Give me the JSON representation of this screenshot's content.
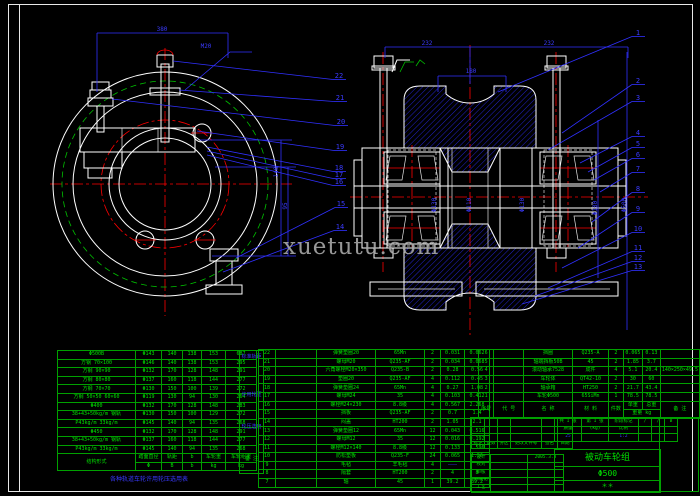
{
  "watermark": {
    "text": "xuetutu.com"
  },
  "colors": {
    "line_white": "#ffffff",
    "line_green": "#00c000",
    "line_red": "#ff0000",
    "line_blue": "#3030ff",
    "table_green": "#00e000",
    "background": "#000000"
  },
  "drawing": {
    "callouts": [
      {
        "n": "22",
        "x": 339,
        "y": 78,
        "fx": 173,
        "fy": 61
      },
      {
        "n": "21",
        "x": 340,
        "y": 100,
        "fx": 179,
        "fy": 90
      },
      {
        "n": "20",
        "x": 341,
        "y": 124,
        "fx": 112,
        "fy": 99
      },
      {
        "n": "19",
        "x": 340,
        "y": 149,
        "fx": 197,
        "fy": 131
      },
      {
        "n": "18",
        "x": 339,
        "y": 170,
        "fx": 207,
        "fy": 147
      },
      {
        "n": "17",
        "x": 339,
        "y": 177,
        "fx": 207,
        "fy": 151
      },
      {
        "n": "16",
        "x": 339,
        "y": 184,
        "fx": 207,
        "fy": 155
      },
      {
        "n": "15",
        "x": 341,
        "y": 206,
        "fx": 236,
        "fy": 258
      },
      {
        "n": "14",
        "x": 340,
        "y": 229,
        "fx": 223,
        "fy": 272
      },
      {
        "n": "1",
        "x": 638,
        "y": 35,
        "fx": 498,
        "fy": 92
      },
      {
        "n": "2",
        "x": 638,
        "y": 83,
        "fx": 562,
        "fy": 133
      },
      {
        "n": "3",
        "x": 638,
        "y": 100,
        "fx": 548,
        "fy": 150
      },
      {
        "n": "4",
        "x": 638,
        "y": 135,
        "fx": 580,
        "fy": 163
      },
      {
        "n": "5",
        "x": 638,
        "y": 146,
        "fx": 588,
        "fy": 172
      },
      {
        "n": "6",
        "x": 638,
        "y": 157,
        "fx": 594,
        "fy": 180
      },
      {
        "n": "7",
        "x": 638,
        "y": 171,
        "fx": 600,
        "fy": 192
      },
      {
        "n": "8",
        "x": 638,
        "y": 191,
        "fx": 592,
        "fy": 222
      },
      {
        "n": "9",
        "x": 638,
        "y": 211,
        "fx": 578,
        "fy": 248
      },
      {
        "n": "10",
        "x": 638,
        "y": 231,
        "fx": 562,
        "fy": 268
      },
      {
        "n": "11",
        "x": 638,
        "y": 250,
        "fx": 548,
        "fy": 288
      },
      {
        "n": "12",
        "x": 638,
        "y": 260,
        "fx": 535,
        "fy": 296
      },
      {
        "n": "13",
        "x": 638,
        "y": 269,
        "fx": 522,
        "fy": 304
      }
    ],
    "dims": [
      {
        "t": "380",
        "x": 162,
        "y": 31,
        "rot": 0
      },
      {
        "t": "M20",
        "x": 206,
        "y": 48,
        "rot": 0
      },
      {
        "t": "140",
        "x": 278,
        "y": 172,
        "rot": -90
      },
      {
        "t": "95",
        "x": 287,
        "y": 206,
        "rot": -90
      },
      {
        "t": "232",
        "x": 427,
        "y": 45,
        "rot": 0
      },
      {
        "t": "232",
        "x": 549,
        "y": 45,
        "rot": 0
      },
      {
        "t": "180",
        "x": 471,
        "y": 73,
        "rot": 0
      },
      {
        "t": "Φ130",
        "x": 436,
        "y": 205,
        "rot": -90
      },
      {
        "t": "Φ110",
        "x": 471,
        "y": 205,
        "rot": -90
      },
      {
        "t": "Φ130",
        "x": 524,
        "y": 205,
        "rot": -90
      },
      {
        "t": "Φ180",
        "x": 597,
        "y": 208,
        "rot": -90
      },
      {
        "t": "Φ500",
        "x": 626,
        "y": 205,
        "rot": -90
      }
    ]
  },
  "spec_table": {
    "rows": [
      [
        {
          "t": "Φ500B",
          "w": 75
        },
        {
          "t": "Φ143",
          "w": 23
        },
        {
          "t": "140",
          "w": 18
        },
        {
          "t": "138",
          "w": 16
        },
        {
          "t": "153",
          "w": 21
        },
        {
          "t": "687",
          "w": 28
        }
      ],
      [
        "方钢 70×100",
        "Φ146",
        "140",
        "138",
        "153",
        "295"
      ],
      [
        "方钢 90×90",
        "Φ132",
        "170",
        "128",
        "148",
        "291"
      ],
      [
        "方钢 80×80",
        "Φ137",
        "160",
        "118",
        "144",
        "277"
      ],
      [
        "方钢 70×70",
        "Φ130",
        "150",
        "100",
        "139",
        "272"
      ],
      [
        "方钢 50×50 60×60",
        "Φ119",
        "130",
        "94",
        "130",
        "264"
      ],
      [
        "Φ400",
        "Φ132",
        "170",
        "128",
        "148",
        "283"
      ],
      [
        "38+43+50kg/m 钢轨",
        "Φ130",
        "150",
        "100",
        "129",
        "272"
      ],
      [
        "P43kg/m 33kg/m",
        "Φ145",
        "140",
        "94",
        "135",
        "268"
      ],
      [
        "Φ450",
        "Φ132",
        "170",
        "128",
        "148",
        "291"
      ],
      [
        "38+43+50kg/m 钢轨",
        "Φ137",
        "160",
        "118",
        "144",
        "277"
      ],
      [
        "P43kg/m 33kg/m",
        "Φ145",
        "140",
        "94",
        "135",
        "268"
      ],
      [
        {
          "t": "结构形式",
          "rs": 2
        },
        {
          "t": "踏面直径"
        },
        {
          "t": "轨距"
        },
        {
          "t": "b"
        },
        {
          "t": "车轮重"
        },
        {
          "t": "车轮组重"
        }
      ],
      [
        {
          "t": "Φ"
        },
        {
          "t": "B"
        },
        {
          "t": "b"
        },
        {
          "t": "kg"
        },
        {
          "t": "kg"
        }
      ]
    ],
    "notes": [
      {
        "t": "标准轨距",
        "top": 4,
        "cls": ""
      },
      {
        "t": "许用轮压",
        "top": 42,
        "cls": ""
      },
      {
        "t": "轮压选用",
        "top": 74,
        "cls": ""
      },
      {
        "t": "备 注",
        "top": 106,
        "cls": "grn"
      }
    ],
    "caption": "各种轨道车轮许用轮压选用表"
  },
  "bom_left": {
    "rows": [
      [
        {
          "t": "22",
          "w": 14
        },
        {
          "t": "",
          "w": 38
        },
        {
          "t": "弹簧垫圈20",
          "w": 56
        },
        {
          "t": "65Mn",
          "w": 46
        },
        {
          "t": "2",
          "w": 13
        },
        {
          "t": "0.031",
          "w": 21
        },
        {
          "t": "0.062",
          "w": 22
        }
      ],
      [
        "21",
        "",
        "螺母M20",
        "Q235-AF",
        "2",
        "0.034",
        "0.068"
      ],
      [
        "20",
        "",
        "六角螺栓M20×350",
        "Q235-B",
        "2",
        "0.28",
        "0.56"
      ],
      [
        "19",
        "",
        "垫圈20",
        "Q235-AF",
        "4",
        "0.112",
        "0.45"
      ],
      [
        "18",
        "",
        "弹簧垫圈24",
        "65Mn",
        "4",
        "0.27",
        "1.08"
      ],
      [
        "17",
        "",
        "螺母M24",
        "35",
        "4",
        "0.103",
        "0.412"
      ],
      [
        "16",
        "",
        "螺栓M24×230",
        "8.8级",
        "4",
        "0.567",
        "2.268"
      ],
      [
        "15",
        "",
        "挡板",
        "Q235-AF",
        "2",
        "0.7",
        "1.4"
      ],
      [
        "14",
        "",
        "闷盖",
        "HT200",
        "2",
        "1.05",
        "2.1"
      ],
      [
        "13",
        "",
        "弹簧垫圈12",
        "65Mn",
        "12",
        "0.043",
        "0.516"
      ],
      [
        "12",
        "",
        "螺母M12",
        "35",
        "12",
        "0.016",
        "0.192"
      ],
      [
        "11",
        "",
        "螺栓M12×140",
        "8.8级",
        "12",
        "0.133",
        "1.596"
      ],
      [
        "10",
        "",
        "防松垫板",
        "Q235-F",
        "24",
        "0.065",
        "1.56"
      ],
      [
        "9",
        "",
        "毛毡",
        "羊毛毡",
        "4",
        {
          "t": "———",
          "cls": "blue"
        },
        ""
      ],
      [
        "8",
        "",
        "隔套",
        "HT200",
        "2",
        "4",
        "8"
      ],
      [
        "7",
        "",
        "轴",
        "45",
        "1",
        "39.2",
        "39.2"
      ]
    ]
  },
  "bom_right": {
    "rows": [
      [
        {
          "t": "6",
          "w": 14
        },
        {
          "t": "",
          "w": 37
        },
        {
          "t": "挡圈",
          "w": 56
        },
        {
          "t": "Q235-A",
          "w": 42
        },
        {
          "t": "2",
          "w": 13
        },
        {
          "t": "0.065",
          "w": 17
        },
        {
          "t": "0.13",
          "w": 17
        },
        {
          "t": "",
          "w": 21
        }
      ],
      [
        "5",
        "",
        "轴端挡板50B",
        "45",
        "2",
        "1.85",
        "3.7",
        ""
      ],
      [
        "4",
        "",
        "滚动轴承7528",
        "成件",
        "4",
        "5.1",
        "20.4",
        "140×250×49.5"
      ],
      [
        "3",
        "",
        "车轮体",
        "QT42-10",
        "2",
        "30",
        "60",
        ""
      ],
      [
        "2",
        "",
        "轴承箱",
        "HT250",
        "2",
        "21.7",
        "43.4",
        ""
      ],
      [
        "1",
        "",
        "车轮Φ500",
        "65SiMn",
        "1",
        "78.5",
        "78.5",
        ""
      ],
      [
        {
          "t": "序号",
          "rs": 2
        },
        {
          "t": "代 号",
          "rs": 2
        },
        {
          "t": "名 称",
          "rs": 2
        },
        {
          "t": "材 料",
          "rs": 2
        },
        {
          "t": "件数",
          "rs": 2
        },
        {
          "t": "单重"
        },
        {
          "t": "总重"
        },
        {
          "t": "备 注",
          "rs": 2
        }
      ],
      [
        {
          "t": "重量 kg",
          "cs": 2
        }
      ]
    ]
  },
  "titleblock": {
    "left_top": {
      "rows": [
        [
          {
            "t": "",
            "w": 10
          },
          {
            "t": "",
            "w": 10
          },
          {
            "t": "",
            "w": 10
          },
          {
            "t": "",
            "w": 28
          },
          {
            "t": "",
            "w": 13
          },
          {
            "t": "",
            "w": 12
          }
        ],
        [
          "",
          "",
          "",
          "",
          "",
          ""
        ],
        [
          "",
          "",
          "",
          "",
          "",
          ""
        ],
        [
          "标记",
          "处数",
          "分区",
          "更改文件号",
          "签名",
          "日期"
        ]
      ]
    },
    "left_bottom": {
      "rows": [
        [
          {
            "t": "设计",
            "w": 16
          },
          {
            "t": "",
            "w": 34
          },
          {
            "t": "2005.3.3",
            "w": 33
          }
        ],
        [
          "校对",
          "",
          ""
        ],
        [
          "审核",
          "",
          ""
        ],
        [
          "标准化",
          "",
          ""
        ],
        [
          "工艺",
          "",
          ""
        ]
      ]
    },
    "mid": {
      "rows": [
        [
          {
            "t": "共 1 张",
            "w": 24
          },
          {
            "t": "第 1 张",
            "w": 24
          },
          {
            "t": "阶段标记",
            "w": 27
          },
          {
            "t": "∕",
            "w": 10
          },
          {
            "t": "∕",
            "w": 10
          },
          {
            "t": "B",
            "w": 10
          }
        ],
        [
          "质量",
          "(kg)",
          "比例",
          "",
          "",
          ""
        ],
        [
          {
            "t": "25",
            "cls": "blue"
          },
          "",
          {
            "t": "1:2",
            "cls": "blue"
          },
          "",
          "",
          ""
        ]
      ]
    },
    "name_line1": "被动车轮组",
    "name_line2": "Φ500",
    "name_line3": "＊＊"
  }
}
